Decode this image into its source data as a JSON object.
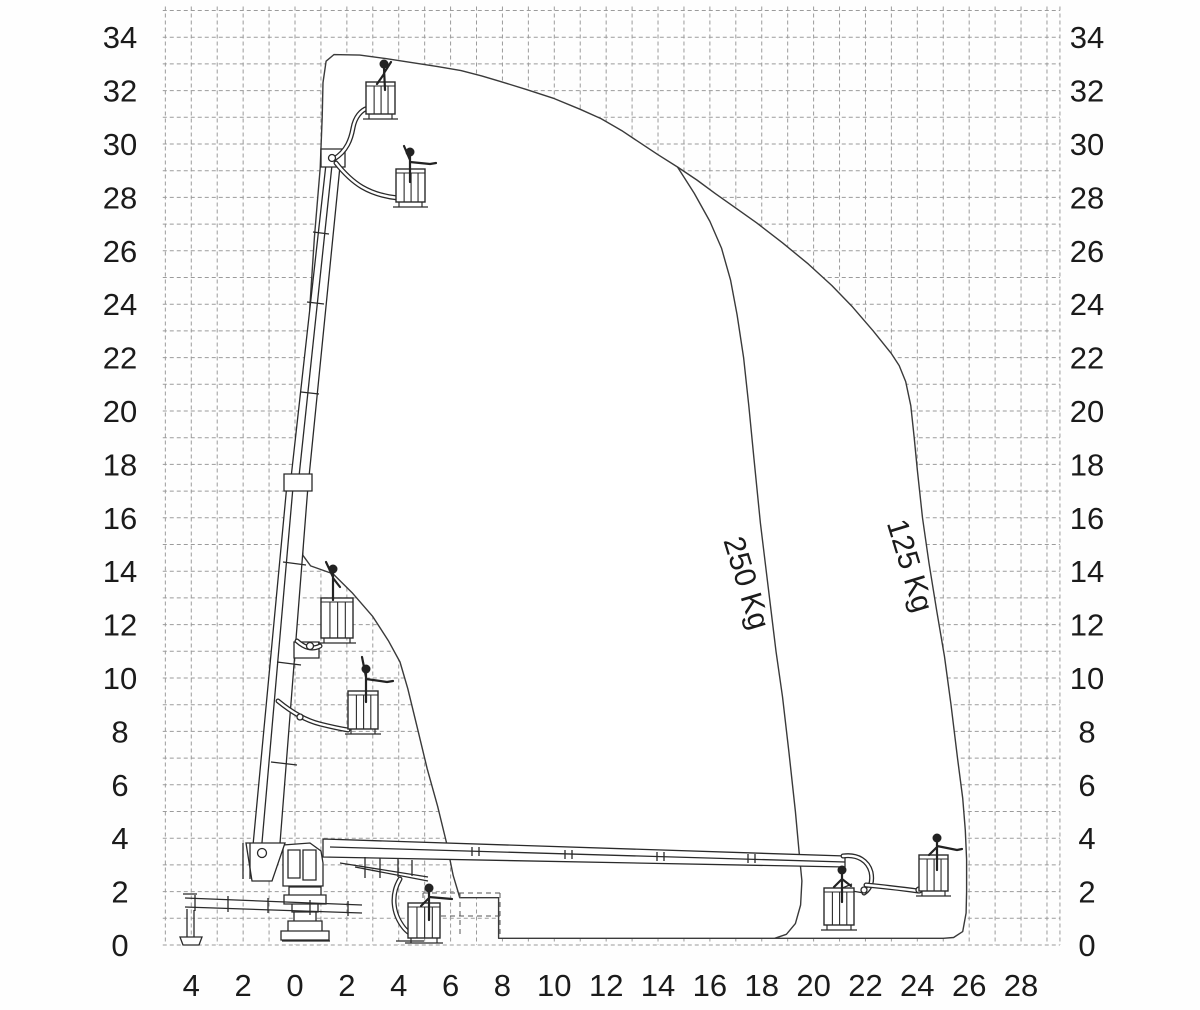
{
  "chart_data": {
    "type": "line",
    "title": "",
    "xlabel": "",
    "ylabel": "",
    "grid": {
      "x_min": -5,
      "x_max": 29,
      "x_edge": 29.5,
      "y_min": 0,
      "y_max": 35,
      "y_top": 35.15,
      "x_left": -5.1,
      "spacing_m": 1,
      "style": "dashed"
    },
    "x_axis": {
      "values": [
        -4,
        -2,
        0,
        2,
        4,
        6,
        8,
        10,
        12,
        14,
        16,
        18,
        20,
        22,
        24,
        26,
        28
      ],
      "labels": [
        "4",
        "2",
        "0",
        "2",
        "4",
        "6",
        "8",
        "10",
        "12",
        "14",
        "16",
        "18",
        "20",
        "22",
        "24",
        "26",
        "28"
      ]
    },
    "y_axis_left": {
      "values": [
        0,
        2,
        4,
        6,
        8,
        10,
        12,
        14,
        16,
        18,
        20,
        22,
        24,
        26,
        28,
        30,
        32,
        34
      ],
      "labels": [
        "0",
        "2",
        "4",
        "6",
        "8",
        "10",
        "12",
        "14",
        "16",
        "18",
        "20",
        "22",
        "24",
        "26",
        "28",
        "30",
        "32",
        "34"
      ]
    },
    "y_axis_right": {
      "values": [
        0,
        2,
        4,
        6,
        8,
        10,
        12,
        14,
        16,
        18,
        20,
        22,
        24,
        26,
        28,
        30,
        32,
        34
      ],
      "labels": [
        "0",
        "2",
        "4",
        "6",
        "8",
        "10",
        "12",
        "14",
        "16",
        "18",
        "20",
        "22",
        "24",
        "26",
        "28",
        "30",
        "32",
        "34"
      ]
    },
    "series": [
      {
        "name": "125 Kg",
        "role": "outer-envelope",
        "closed": true,
        "points": [
          [
            1.5,
            33.35
          ],
          [
            2.5,
            33.33
          ],
          [
            3.5,
            33.2
          ],
          [
            4.5,
            33.05
          ],
          [
            5.5,
            32.9
          ],
          [
            6.4,
            32.75
          ],
          [
            7.2,
            32.55
          ],
          [
            7.9,
            32.35
          ],
          [
            8.9,
            32.05
          ],
          [
            10,
            31.7
          ],
          [
            11,
            31.3
          ],
          [
            11.8,
            30.95
          ],
          [
            12.6,
            30.5
          ],
          [
            13.3,
            30.05
          ],
          [
            14.0,
            29.6
          ],
          [
            14.75,
            29.14
          ],
          [
            15.5,
            28.65
          ],
          [
            16.2,
            28.15
          ],
          [
            17.0,
            27.6
          ],
          [
            17.8,
            27.05
          ],
          [
            18.8,
            26.3
          ],
          [
            19.8,
            25.5
          ],
          [
            20.7,
            24.7
          ],
          [
            21.5,
            23.9
          ],
          [
            22.3,
            23.0
          ],
          [
            23.0,
            22.15
          ],
          [
            23.3,
            21.7
          ],
          [
            23.55,
            21.1
          ],
          [
            23.75,
            20.2
          ],
          [
            23.88,
            19.0
          ],
          [
            24.0,
            17.8
          ],
          [
            24.2,
            16.0
          ],
          [
            24.45,
            14.3
          ],
          [
            24.75,
            12.5
          ],
          [
            25.05,
            10.8
          ],
          [
            25.3,
            9.0
          ],
          [
            25.55,
            7.0
          ],
          [
            25.75,
            5.5
          ],
          [
            25.85,
            4.3
          ],
          [
            25.9,
            3.2
          ],
          [
            25.9,
            2.0
          ],
          [
            25.88,
            1.2
          ],
          [
            25.75,
            0.5
          ],
          [
            25.4,
            0.28
          ],
          [
            25.0,
            0.25
          ],
          [
            7.85,
            0.25
          ],
          [
            7.85,
            1.77
          ],
          [
            6.35,
            1.77
          ],
          [
            6.3,
            1.95
          ],
          [
            6.1,
            2.6
          ],
          [
            5.85,
            3.8
          ],
          [
            5.5,
            5.2
          ],
          [
            5.1,
            6.6
          ],
          [
            4.7,
            8.2
          ],
          [
            4.35,
            9.6
          ],
          [
            4.05,
            10.6
          ],
          [
            3.6,
            11.4
          ],
          [
            3.0,
            12.3
          ],
          [
            2.2,
            13.2
          ],
          [
            1.47,
            13.9
          ],
          [
            0.6,
            14.2
          ],
          [
            0.3,
            14.6
          ],
          [
            0.35,
            17.0
          ],
          [
            0.45,
            20.0
          ],
          [
            0.58,
            24.0
          ],
          [
            0.75,
            26.5
          ],
          [
            0.97,
            29.1
          ],
          [
            1.05,
            31.0
          ],
          [
            1.08,
            32.3
          ],
          [
            1.2,
            33.1
          ]
        ]
      },
      {
        "name": "250 Kg",
        "role": "inner-envelope",
        "closed": false,
        "points": [
          [
            14.75,
            29.14
          ],
          [
            15.4,
            28.15
          ],
          [
            16.0,
            27.1
          ],
          [
            16.45,
            26.1
          ],
          [
            16.8,
            24.9
          ],
          [
            17.05,
            23.6
          ],
          [
            17.3,
            22.0
          ],
          [
            17.5,
            20.2
          ],
          [
            17.7,
            18.2
          ],
          [
            17.95,
            15.8
          ],
          [
            18.25,
            13.4
          ],
          [
            18.55,
            11.0
          ],
          [
            18.8,
            9.3
          ],
          [
            19.05,
            7.2
          ],
          [
            19.3,
            5.0
          ],
          [
            19.45,
            3.4
          ],
          [
            19.55,
            2.4
          ],
          [
            19.5,
            1.5
          ],
          [
            19.3,
            0.8
          ],
          [
            18.95,
            0.4
          ],
          [
            18.5,
            0.25
          ]
        ]
      }
    ],
    "annotations": [
      {
        "text": "250 Kg",
        "x": 17.05,
        "y": 13.45,
        "rotation": 73
      },
      {
        "text": "125 Kg",
        "x": 23.35,
        "y": 14.1,
        "rotation": 73
      }
    ]
  },
  "colors": {
    "grid": "#9b9b9b",
    "envelope_stroke": "#3a3a3a",
    "machine_stroke": "#2a2a2a",
    "text": "#1b1b1b",
    "background": "#fefefe"
  },
  "machine": {
    "paths": [
      {
        "d": "M252,856 L279,856 L308,486 L287,484 Z",
        "fill": "#ffffff"
      },
      {
        "d": "M261,854 L293,487"
      },
      {
        "d": "M290,487 L308,487 L340,166 L326,164 Z",
        "fill": "#ffffff"
      },
      {
        "d": "M298,486 L332,165"
      },
      {
        "d": "M284,474 h28 v17 h-28 Z",
        "fill": "#ffffff"
      },
      {
        "d": "M294,642 h25 v16 h-25 Z",
        "fill": "#ffffff"
      },
      {
        "d": "M321,149 h24 v18 h-24 Z",
        "fill": "#ffffff"
      },
      {
        "d": "M271,762 l26,3 M277,662 l24,3 M283,562 l23,3 M301,392 l18,2 M307,302 l17,2 M313,232 l16,2"
      },
      {
        "d": "M283,845 L310,843 L321,851 L323,863 L323,886 L283,886 Z",
        "fill": "#ffffff"
      },
      {
        "d": "M288,850 h12 v28 h-12 Z M303,850 h13 v30 h-13 Z"
      },
      {
        "d": "M289,887 h32 v8 h-32 Z M284,895 h42 v9 h-42 Z M292,904 h26 v8 h-26 Z",
        "fill": "#ffffff"
      },
      {
        "d": "M294,912 h22 v9 h-22 Z M288,921 h34 v10 h-34 Z M281,931 h48 v9 h-48 Z",
        "fill": "#ffffff"
      },
      {
        "d": "M323,839 L845,856 L845,867 L323,857 Z",
        "fill": "#ffffff"
      },
      {
        "d": "M330,847 L845,862"
      },
      {
        "d": "M472,847 v9 M479,847 v9 M565,850 v9 M572,850 v9 M657,852 v9 M664,852 v9 M748,854 v9 M755,854 v9"
      },
      {
        "d": "M365,857 v21 M380,858 v20 M398,859 v18 M412,860 v16 M340,863 L428,877 M355,867 L428,881"
      },
      {
        "d": "M246,843 L285,843 L272,881 L252,881 Z",
        "fill": "#ffffff"
      },
      {
        "d": "M243,843 v36 M250,843 v36"
      },
      {
        "d": "M185,898 L362,905 M185,907 L362,913"
      },
      {
        "d": "M195,895 v16 M228,896 v16 M268,898 v15 M310,900 v15 M348,901 v15"
      },
      {
        "d": "M183,894 h14 M187,909 v28 M194,910 v28"
      },
      {
        "d": "M180,937 L202,937 L199,945 L183,945 Z",
        "fill": "#ffffff"
      },
      {
        "d": "M282,941 h48"
      },
      {
        "d": "M396,941 h28"
      },
      {
        "d": "M852,884 L840,889 M864,893 L852,891"
      },
      {
        "d": "M423,893 h77 M423,916 h77 M423,893 v45 M460,893 v45 M500,893 v45",
        "dash": "5 4",
        "w": 1,
        "color": "#555555"
      }
    ],
    "tubes": [
      "M334,159 C347,151 351,139 353,128 C355,117 361,110 368,108",
      "M336,163 C344,173 352,181 362,187 C374,194 388,197 398,198",
      "M297,641 C305,648 312,650 320,646",
      "M278,701 C295,715 308,721 320,724 C332,727 342,729 348,730",
      "M843,856 C858,854 868,861 871,872 C873,882 870,889 864,893",
      "M866,885 C886,887 904,889 918,891",
      "M400,879 C391,894 392,913 404,928 C409,934 414,936 420,936"
    ],
    "circles": [
      [
        332,
        158,
        3.5
      ],
      [
        262,
        853,
        4.5
      ],
      [
        310,
        646,
        3.5
      ],
      [
        300,
        717,
        3
      ],
      [
        864,
        890,
        3
      ],
      [
        919,
        890,
        3
      ],
      [
        420,
        934,
        3
      ]
    ],
    "baskets": [
      [
        366,
        82,
        29,
        32
      ],
      [
        396,
        169,
        29,
        33
      ],
      [
        321,
        598,
        32,
        40
      ],
      [
        348,
        691,
        30,
        38
      ],
      [
        408,
        903,
        32,
        35
      ],
      [
        824,
        888,
        30,
        37
      ],
      [
        919,
        855,
        29,
        36
      ]
    ],
    "persons": [
      {
        "head": [
          384,
          64
        ],
        "d": "M384,68 L385,90 M384,73 L391,62 M384,74 L377,84"
      },
      {
        "head": [
          410,
          152
        ],
        "d": "M410,156 L410,182 M410,160 L404,146 M410,162 L430,164 L436,163"
      },
      {
        "head": [
          333,
          569
        ],
        "d": "M333,573 L333,600 M333,577 L326,562 M333,578 L340,587"
      },
      {
        "head": [
          366,
          669
        ],
        "d": "M366,673 L366,702 M366,677 L362,657 M366,679 L387,682 L393,681"
      },
      {
        "head": [
          429,
          888
        ],
        "d": "M429,892 L429,920 M429,897 L452,899 M429,898 L421,906"
      },
      {
        "head": [
          842,
          870
        ],
        "d": "M842,874 L842,902 M842,879 L851,886 M842,879 L834,887"
      },
      {
        "head": [
          937,
          838
        ],
        "d": "M937,842 L937,870 M937,846 L957,850 L962,849 M937,847 L929,855"
      }
    ]
  }
}
